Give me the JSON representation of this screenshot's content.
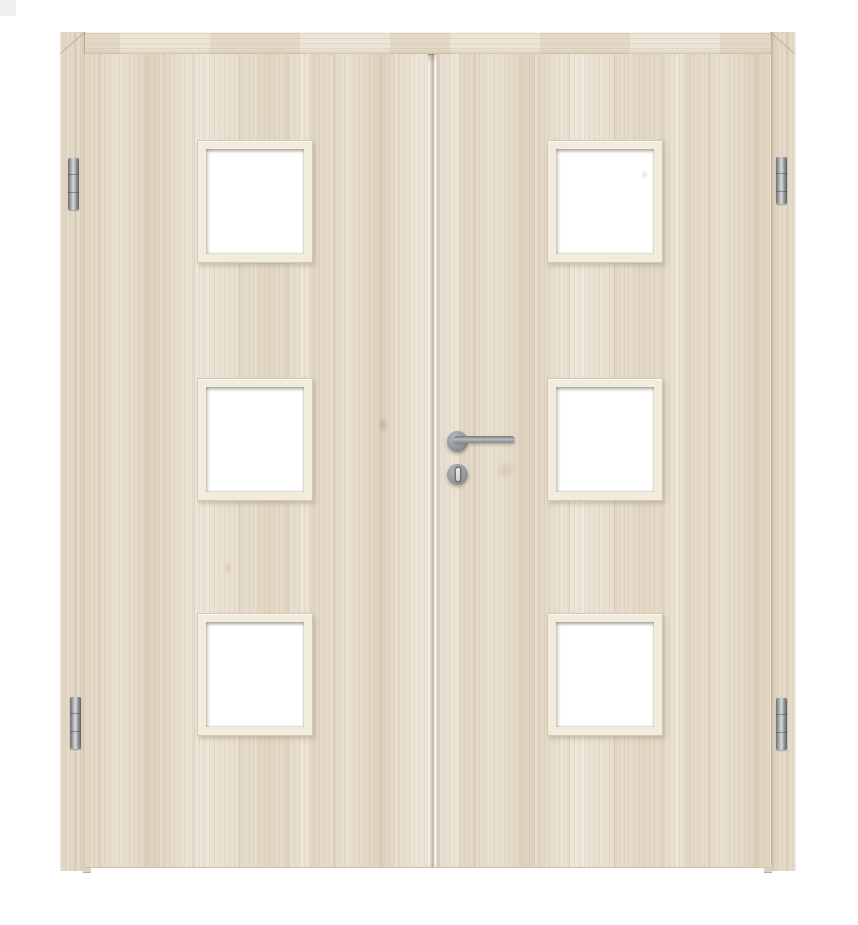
{
  "scene": {
    "description": "Product photograph of a light wood laminate double interior door, hinged frame, no visible text",
    "background_color": "#ffffff",
    "corner_artifact_color": "#efefef"
  },
  "door": {
    "leaf_count": 2,
    "wood": {
      "base_color": "#e8dfcf",
      "grain_dark": "#cdbfa6",
      "grain_light": "#f2ece0",
      "grain_direction_leaves": "vertical",
      "grain_direction_top_rail": "horizontal"
    },
    "frame": {
      "color": "#e9e0d0",
      "mitred_corners": true
    },
    "glazing": {
      "cutouts_per_leaf": 3,
      "total_cutouts": 6,
      "shape": "square",
      "frame_color": "#f2ecdd",
      "glass_color": "#ffffff"
    },
    "meeting_gap": {
      "position": "center",
      "shadow_color": "#766246"
    },
    "hardware": {
      "handle": {
        "type": "straight lever on round rose",
        "mounted_on": "right-leaf",
        "lever_direction": "right",
        "color": "#8f9396"
      },
      "escutcheon": {
        "type": "round with keyhole",
        "color": "#90959a",
        "keyhole_color": "#e0e0e0"
      },
      "hinges": {
        "count": 4,
        "placement": "two per side, top and bottom",
        "color": "#9fa2a4"
      }
    }
  }
}
